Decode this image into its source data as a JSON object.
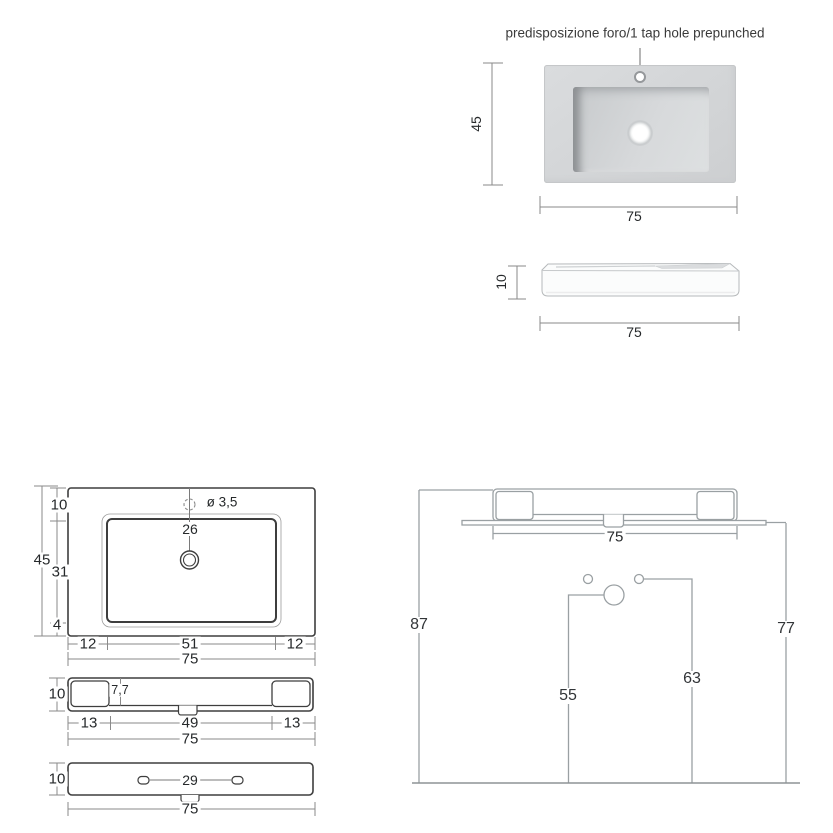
{
  "title": "predisposizione foro/1 tap hole prepunched",
  "colors": {
    "object_line": "#3e3e3e",
    "dimension_line": "#8a8a8a",
    "installation_line": "#9aa0a3",
    "label_text": "#26292b",
    "render_body": "#d4d6d8",
    "render_shadow": "#8e9194"
  },
  "views": {
    "top_rendered": {
      "depth": "45",
      "width": "75"
    },
    "side_rendered": {
      "thickness": "10",
      "width": "75"
    },
    "plan": {
      "overall_depth": "45",
      "back_margin": "10",
      "basin_span": "31",
      "front_margin": "4",
      "tap_hole_diameter": "ø 3,5",
      "tap_hole_to_drain": "26",
      "left_margin": "12",
      "basin_width": "51",
      "right_margin": "12",
      "overall_width": "75"
    },
    "front": {
      "height": "10",
      "basin_inner_depth": "7,7",
      "left_margin": "13",
      "basin_span": "49",
      "right_margin": "13",
      "overall_width": "75"
    },
    "underside": {
      "height": "10",
      "slot_spacing": "29",
      "overall_width": "75"
    },
    "installation": {
      "floor_to_top": "87",
      "floor_to_underside": "77",
      "width": "75",
      "drain_height": "55",
      "supply_height": "63"
    }
  }
}
